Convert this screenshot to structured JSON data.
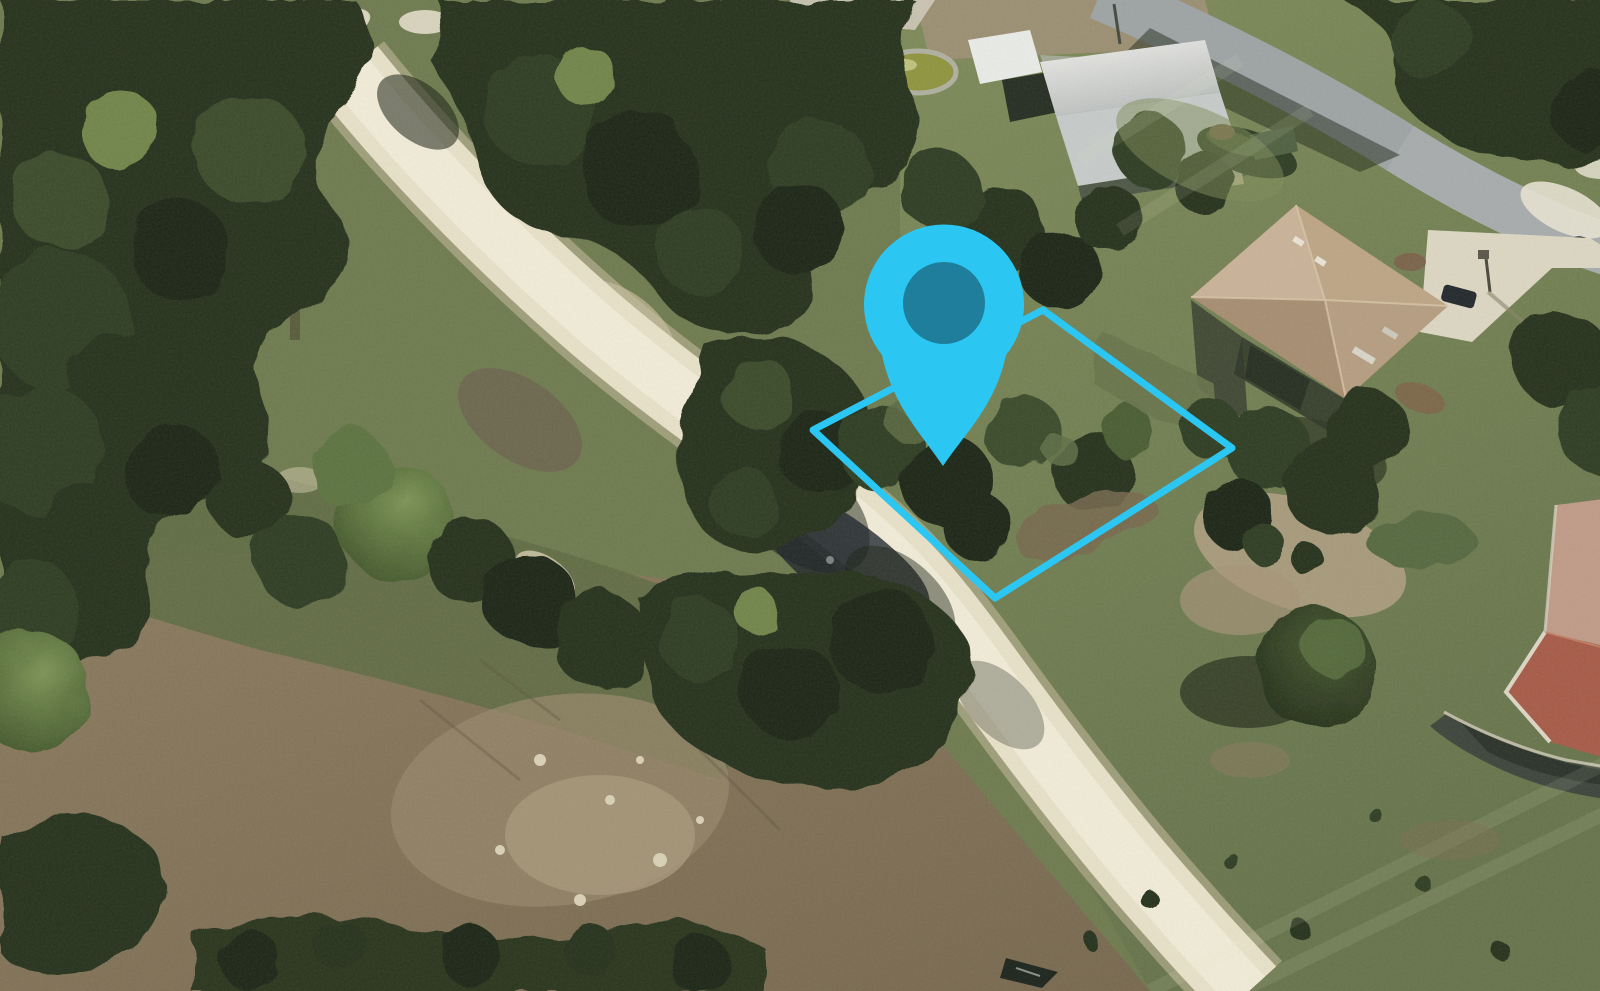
{
  "view": {
    "kind": "3d-aerial-satellite-photo",
    "description": "Oblique aerial photo of a vacant wooded residential lot beside a dirt road, marked with a map pin and a highlighted parcel boundary",
    "width": 1600,
    "height": 991
  },
  "overlay": {
    "accent_color": "#2BC7F2",
    "location_pin": {
      "icon": "map-pin",
      "outer_color": "#2BC7F2",
      "path": "M 943 466 C 920 432 893 406 882 355 A 80 80 0 1 1 1006 355 C 995 406 966 432 943 466 Z",
      "anchor_x": 943,
      "anchor_y": 466,
      "inner_circle": {
        "cx": 944,
        "cy": 303,
        "r": 41,
        "color": "#1E7E9C"
      }
    },
    "parcel_outline": {
      "points": "813,430 1043,310 1232,448 995,598",
      "color": "#2BC7F2",
      "stroke_width": 7
    }
  },
  "terrain": {
    "features": [
      "dense-tree-canopy-northwest",
      "sand-dirt-road-diagonal",
      "paved-road-top-right",
      "vacant-lot-scrub-inside-parcel",
      "white-metal-barn",
      "round-pond-green-water",
      "tan-hip-roof-house-with-driveway",
      "red-tile-roof-house-bottom-right",
      "dry-brown-field-bottom-left",
      "mowed-lawns-east"
    ],
    "palette": {
      "canopy_dark": "#25311B",
      "grass_olive": "#6E7B4E",
      "dirt_road": "#EBE4CB",
      "paved_road": "#A7ABAC",
      "dry_field": "#8A7A5E",
      "barn_roof": "#E9EBE7",
      "house_roof_tan": "#B59D80",
      "tile_roof_red": "#A65B47",
      "pond_water": "#8F943E"
    }
  }
}
